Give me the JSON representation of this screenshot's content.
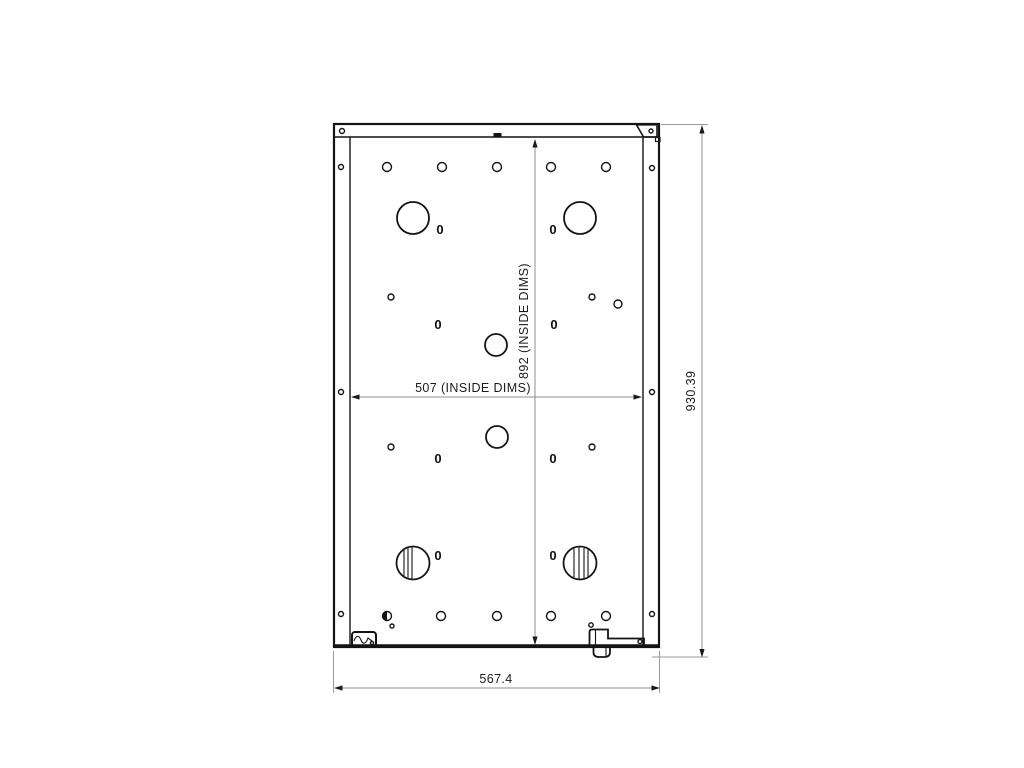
{
  "drawing": {
    "background": "#ffffff",
    "ink_color": "#141414",
    "dim_color": "#8f8f8f",
    "labels": {
      "outer_width": "567.4",
      "overall_depth": "930.39",
      "inside_width": "507 (INSIDE DIMS)",
      "inside_depth": "892  (INSIDE DIMS)"
    },
    "zero_text": "0",
    "zero_callouts": [
      {
        "x": 440,
        "y": 229
      },
      {
        "x": 553,
        "y": 229
      },
      {
        "x": 438,
        "y": 324
      },
      {
        "x": 554,
        "y": 324
      },
      {
        "x": 438,
        "y": 458
      },
      {
        "x": 553,
        "y": 458
      },
      {
        "x": 438,
        "y": 555
      },
      {
        "x": 553,
        "y": 555
      }
    ],
    "holes": [
      {
        "name": "top-row-hole",
        "cx": 387,
        "cy": 167,
        "r": 4.5
      },
      {
        "name": "top-row-hole",
        "cx": 442,
        "cy": 167,
        "r": 4.5
      },
      {
        "name": "top-row-hole",
        "cx": 497,
        "cy": 167,
        "r": 4.5
      },
      {
        "name": "top-row-hole",
        "cx": 551,
        "cy": 167,
        "r": 4.5
      },
      {
        "name": "top-row-hole",
        "cx": 606,
        "cy": 167,
        "r": 4.5
      },
      {
        "name": "bottom-row-hole",
        "cx": 387,
        "cy": 616,
        "r": 4.5,
        "half": true
      },
      {
        "name": "bottom-row-hole",
        "cx": 441,
        "cy": 616,
        "r": 4.5
      },
      {
        "name": "bottom-row-hole",
        "cx": 497,
        "cy": 616,
        "r": 4.5
      },
      {
        "name": "bottom-row-hole",
        "cx": 551,
        "cy": 616,
        "r": 4.5
      },
      {
        "name": "bottom-row-hole",
        "cx": 606,
        "cy": 616,
        "r": 4.5
      },
      {
        "name": "rail-hole",
        "cx": 342,
        "cy": 131,
        "r": 2.5
      },
      {
        "name": "rail-hole",
        "cx": 341,
        "cy": 167,
        "r": 2.5
      },
      {
        "name": "rail-hole",
        "cx": 652,
        "cy": 168,
        "r": 2.5
      },
      {
        "name": "rail-hole",
        "cx": 341,
        "cy": 392,
        "r": 2.5
      },
      {
        "name": "rail-hole",
        "cx": 652,
        "cy": 392,
        "r": 2.5
      },
      {
        "name": "rail-hole",
        "cx": 341,
        "cy": 614,
        "r": 2.5
      },
      {
        "name": "rail-hole",
        "cx": 652,
        "cy": 614,
        "r": 2.5
      },
      {
        "name": "bracket-hole",
        "cx": 651,
        "cy": 131,
        "r": 2
      },
      {
        "name": "large-hole",
        "cx": 413,
        "cy": 218,
        "r": 16
      },
      {
        "name": "large-hole",
        "cx": 580,
        "cy": 218,
        "r": 16
      },
      {
        "name": "center-hole",
        "cx": 496,
        "cy": 345,
        "r": 11
      },
      {
        "name": "center-hole",
        "cx": 497,
        "cy": 437,
        "r": 11
      },
      {
        "name": "pilot-hole",
        "cx": 391,
        "cy": 297,
        "r": 3
      },
      {
        "name": "pilot-hole",
        "cx": 592,
        "cy": 297,
        "r": 3
      },
      {
        "name": "pilot-hole",
        "cx": 618,
        "cy": 304,
        "r": 4
      },
      {
        "name": "pilot-hole",
        "cx": 391,
        "cy": 447,
        "r": 3
      },
      {
        "name": "pilot-hole",
        "cx": 592,
        "cy": 447,
        "r": 3
      },
      {
        "name": "tiny-hole",
        "cx": 392,
        "cy": 626,
        "r": 2
      },
      {
        "name": "tiny-hole",
        "cx": 591,
        "cy": 625,
        "r": 2.2
      },
      {
        "name": "tiny-hole",
        "cx": 640,
        "cy": 641.5,
        "r": 2
      },
      {
        "name": "tiny-hole",
        "cx": 372,
        "cy": 643,
        "r": 1.6
      }
    ],
    "latch_circles": [
      {
        "name": "latch-cam-circle",
        "cx": 413,
        "cy": 563,
        "r": 16.5,
        "stripes": [
          -9,
          -5,
          -1
        ]
      },
      {
        "name": "latch-cam-circle",
        "cx": 580,
        "cy": 563,
        "r": 16.5,
        "stripes": [
          -6,
          -1,
          4,
          8
        ]
      }
    ]
  }
}
